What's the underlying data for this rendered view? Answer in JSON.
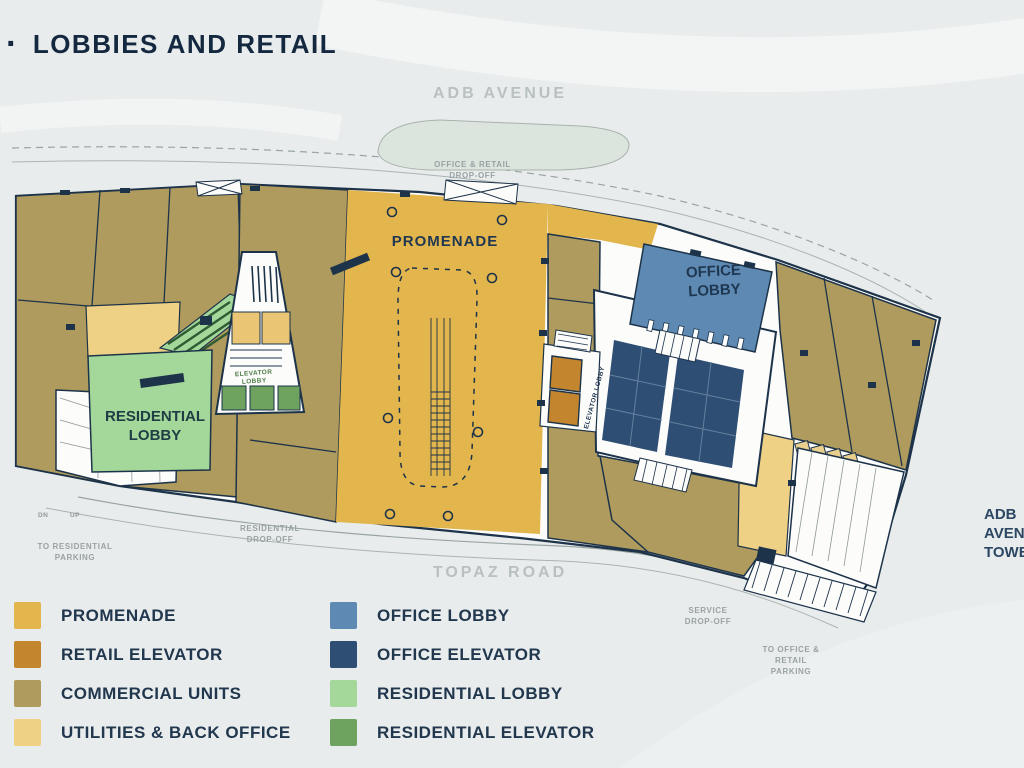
{
  "title": {
    "bullet": "·",
    "text": "LOBBIES AND RETAIL"
  },
  "streets": {
    "top": "ADB AVENUE",
    "bottom": "TOPAZ ROAD"
  },
  "tower_label": "ADB AVENUE TOWER",
  "plan_labels": {
    "promenade": "PROMENADE",
    "office_lobby": "OFFICE LOBBY",
    "residential_lobby": "RESIDENTIAL LOBBY",
    "residential_elevator_lobby": "ELEVATOR LOBBY",
    "retail_elevator_lobby": "ELEVATOR LOBBY",
    "ramp_down": "DN",
    "ramp_up": "UP"
  },
  "road_labels": {
    "office_retail_dropoff": "OFFICE & RETAIL DROP-OFF",
    "residential_dropoff": "RESIDENTIAL DROP-OFF",
    "to_residential_parking": "TO RESIDENTIAL PARKING",
    "service_dropoff": "SERVICE DROP-OFF",
    "to_office_retail_parking": "TO OFFICE & RETAIL PARKING"
  },
  "legend": {
    "items": [
      {
        "label": "PROMENADE",
        "color": "#e3b54d"
      },
      {
        "label": "RETAIL ELEVATOR",
        "color": "#c3862f"
      },
      {
        "label": "COMMERCIAL UNITS",
        "color": "#b09b5e"
      },
      {
        "label": "UTILITIES & BACK OFFICE",
        "color": "#eed185"
      },
      {
        "label": "OFFICE LOBBY",
        "color": "#5d89b3"
      },
      {
        "label": "OFFICE ELEVATOR",
        "color": "#2e4e74"
      },
      {
        "label": "RESIDENTIAL LOBBY",
        "color": "#a4d79a"
      },
      {
        "label": "RESIDENTIAL ELEVATOR",
        "color": "#6da35e"
      }
    ]
  },
  "colors": {
    "background": "#e9ecec",
    "outline": "#1d3349",
    "promenade": "#e3b54d",
    "retail_elevator": "#c3862f",
    "commercial": "#b09b5e",
    "utilities": "#eed185",
    "office_lobby": "#5d89b3",
    "office_elevator": "#2e4e74",
    "residential_lobby": "#a4d79a",
    "residential_elevator": "#6da35e"
  }
}
